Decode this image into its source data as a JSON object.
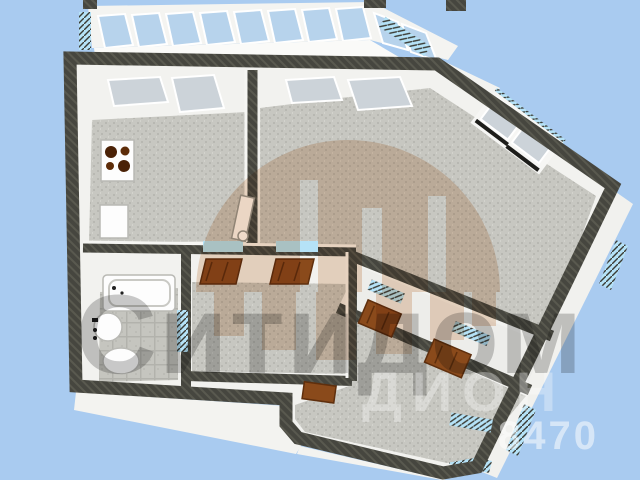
{
  "scene": {
    "type": "3d-floorplan-render",
    "description": "apartment-floor-plan-top-down-3d",
    "rooms": [
      "balcony-loggia",
      "kitchen",
      "living-room",
      "hallway",
      "bathroom",
      "entry-corridor",
      "bedroom"
    ],
    "fixtures": [
      "stove-icon",
      "kitchen-cabinet-icon",
      "bathtub-icon",
      "sink-icon",
      "toilet-icon",
      "door-leaf-icon"
    ]
  },
  "watermarks": {
    "brand_text": "Ситидом",
    "secondary_text": "ДИОН",
    "phone_fragment": "8470",
    "logo": "city-dome-logo"
  },
  "colors": {
    "background": "#a9cbf0",
    "wall": "#46463f",
    "wall-hatch": "#59594f",
    "wall-face": "#f2f2ef",
    "floor": "#c7c7c1",
    "floor-speckle": "#b8b8b2",
    "glass-balcony": "#b7d3ec",
    "glass-window": "#ccd3d9",
    "sill-blue": "#b5e2f7",
    "door-wood": "#8a4a1b",
    "door-wood-dark": "#5f2f0d",
    "fixture-white": "#fdfdfd",
    "wm-orange": "#c8824c",
    "wm-dark": "#3a3a3a",
    "wm-light": "#ffffff"
  }
}
